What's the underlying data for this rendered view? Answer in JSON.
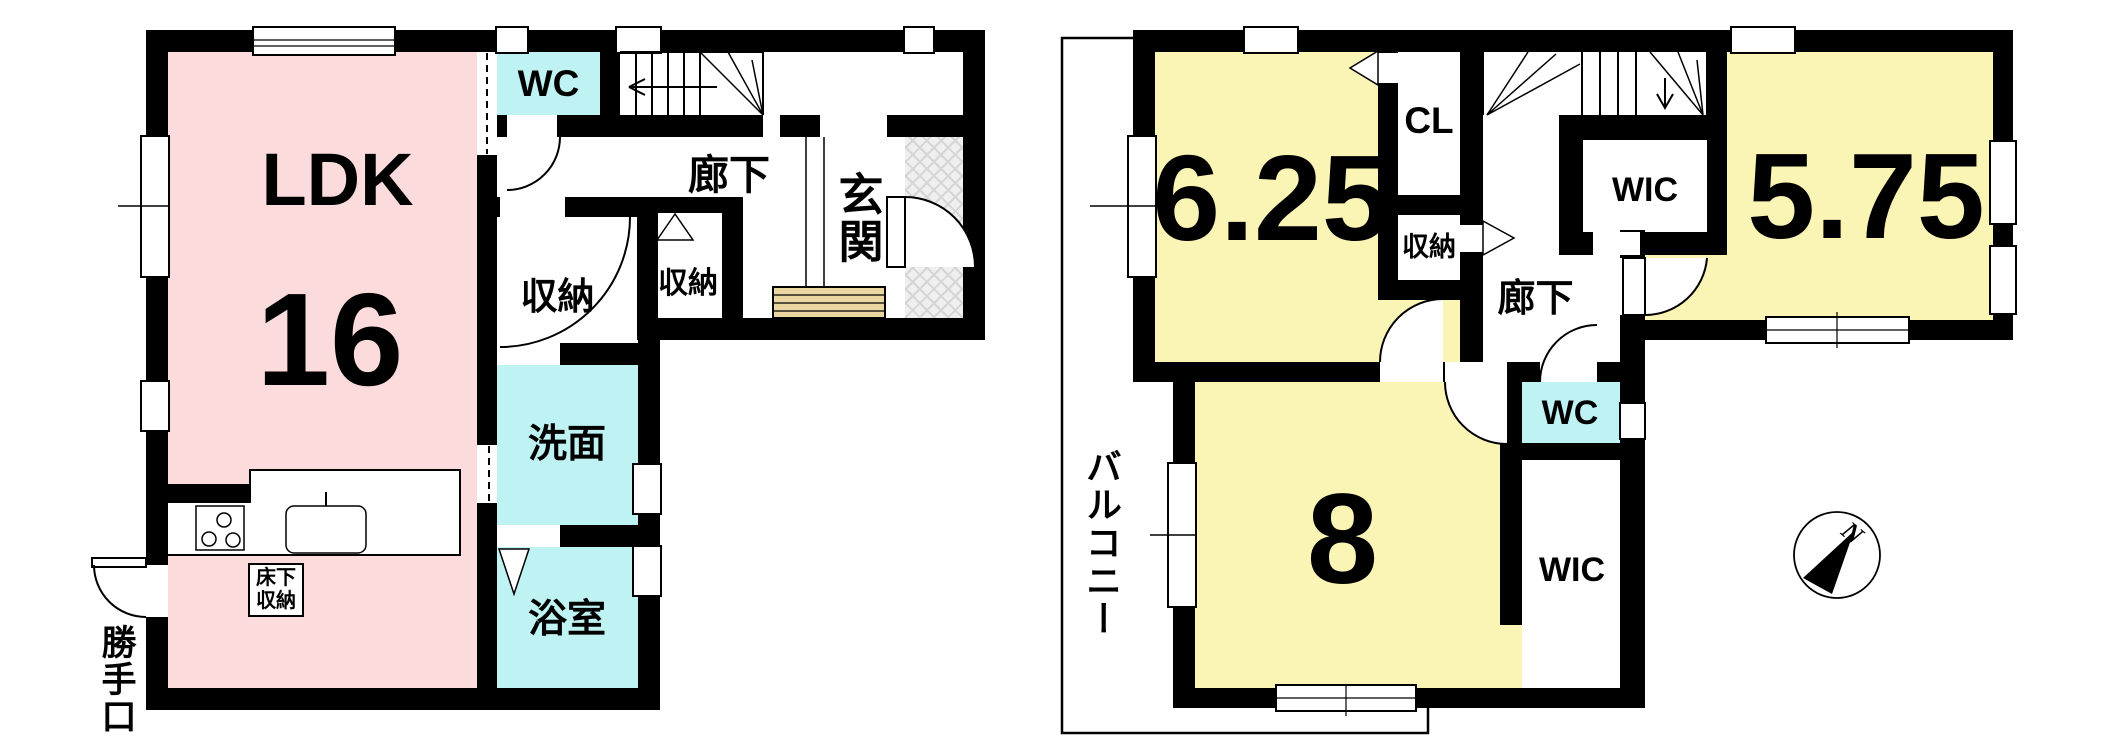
{
  "f1": {
    "ldk": "LDK",
    "ldk_size": "16",
    "wc": "WC",
    "hallway": "廊下",
    "entrance": "玄関",
    "storage_hall": "収納",
    "storage_entry": "収納",
    "washroom": "洗面",
    "bathroom": "浴室",
    "underfloor_line1": "床下",
    "underfloor_line2": "収納",
    "back_door": "勝手口"
  },
  "f2": {
    "room_a": "6.25",
    "room_b": "5.75",
    "room_c": "8",
    "closet": "CL",
    "wic_upper": "WIC",
    "wic_lower": "WIC",
    "wc": "WC",
    "storage": "収納",
    "hallway": "廊下",
    "balcony": "バルコニー",
    "compass_north": "N"
  },
  "colors": {
    "wall": "#000000",
    "ldk_fill": "#FBDBDB",
    "bedroom_fill": "#FAF4B5",
    "sanitary_fill": "#BFF2F2",
    "entry_step_fill": "#E9D6A0",
    "porch_hatch": "#D9D9D9"
  }
}
